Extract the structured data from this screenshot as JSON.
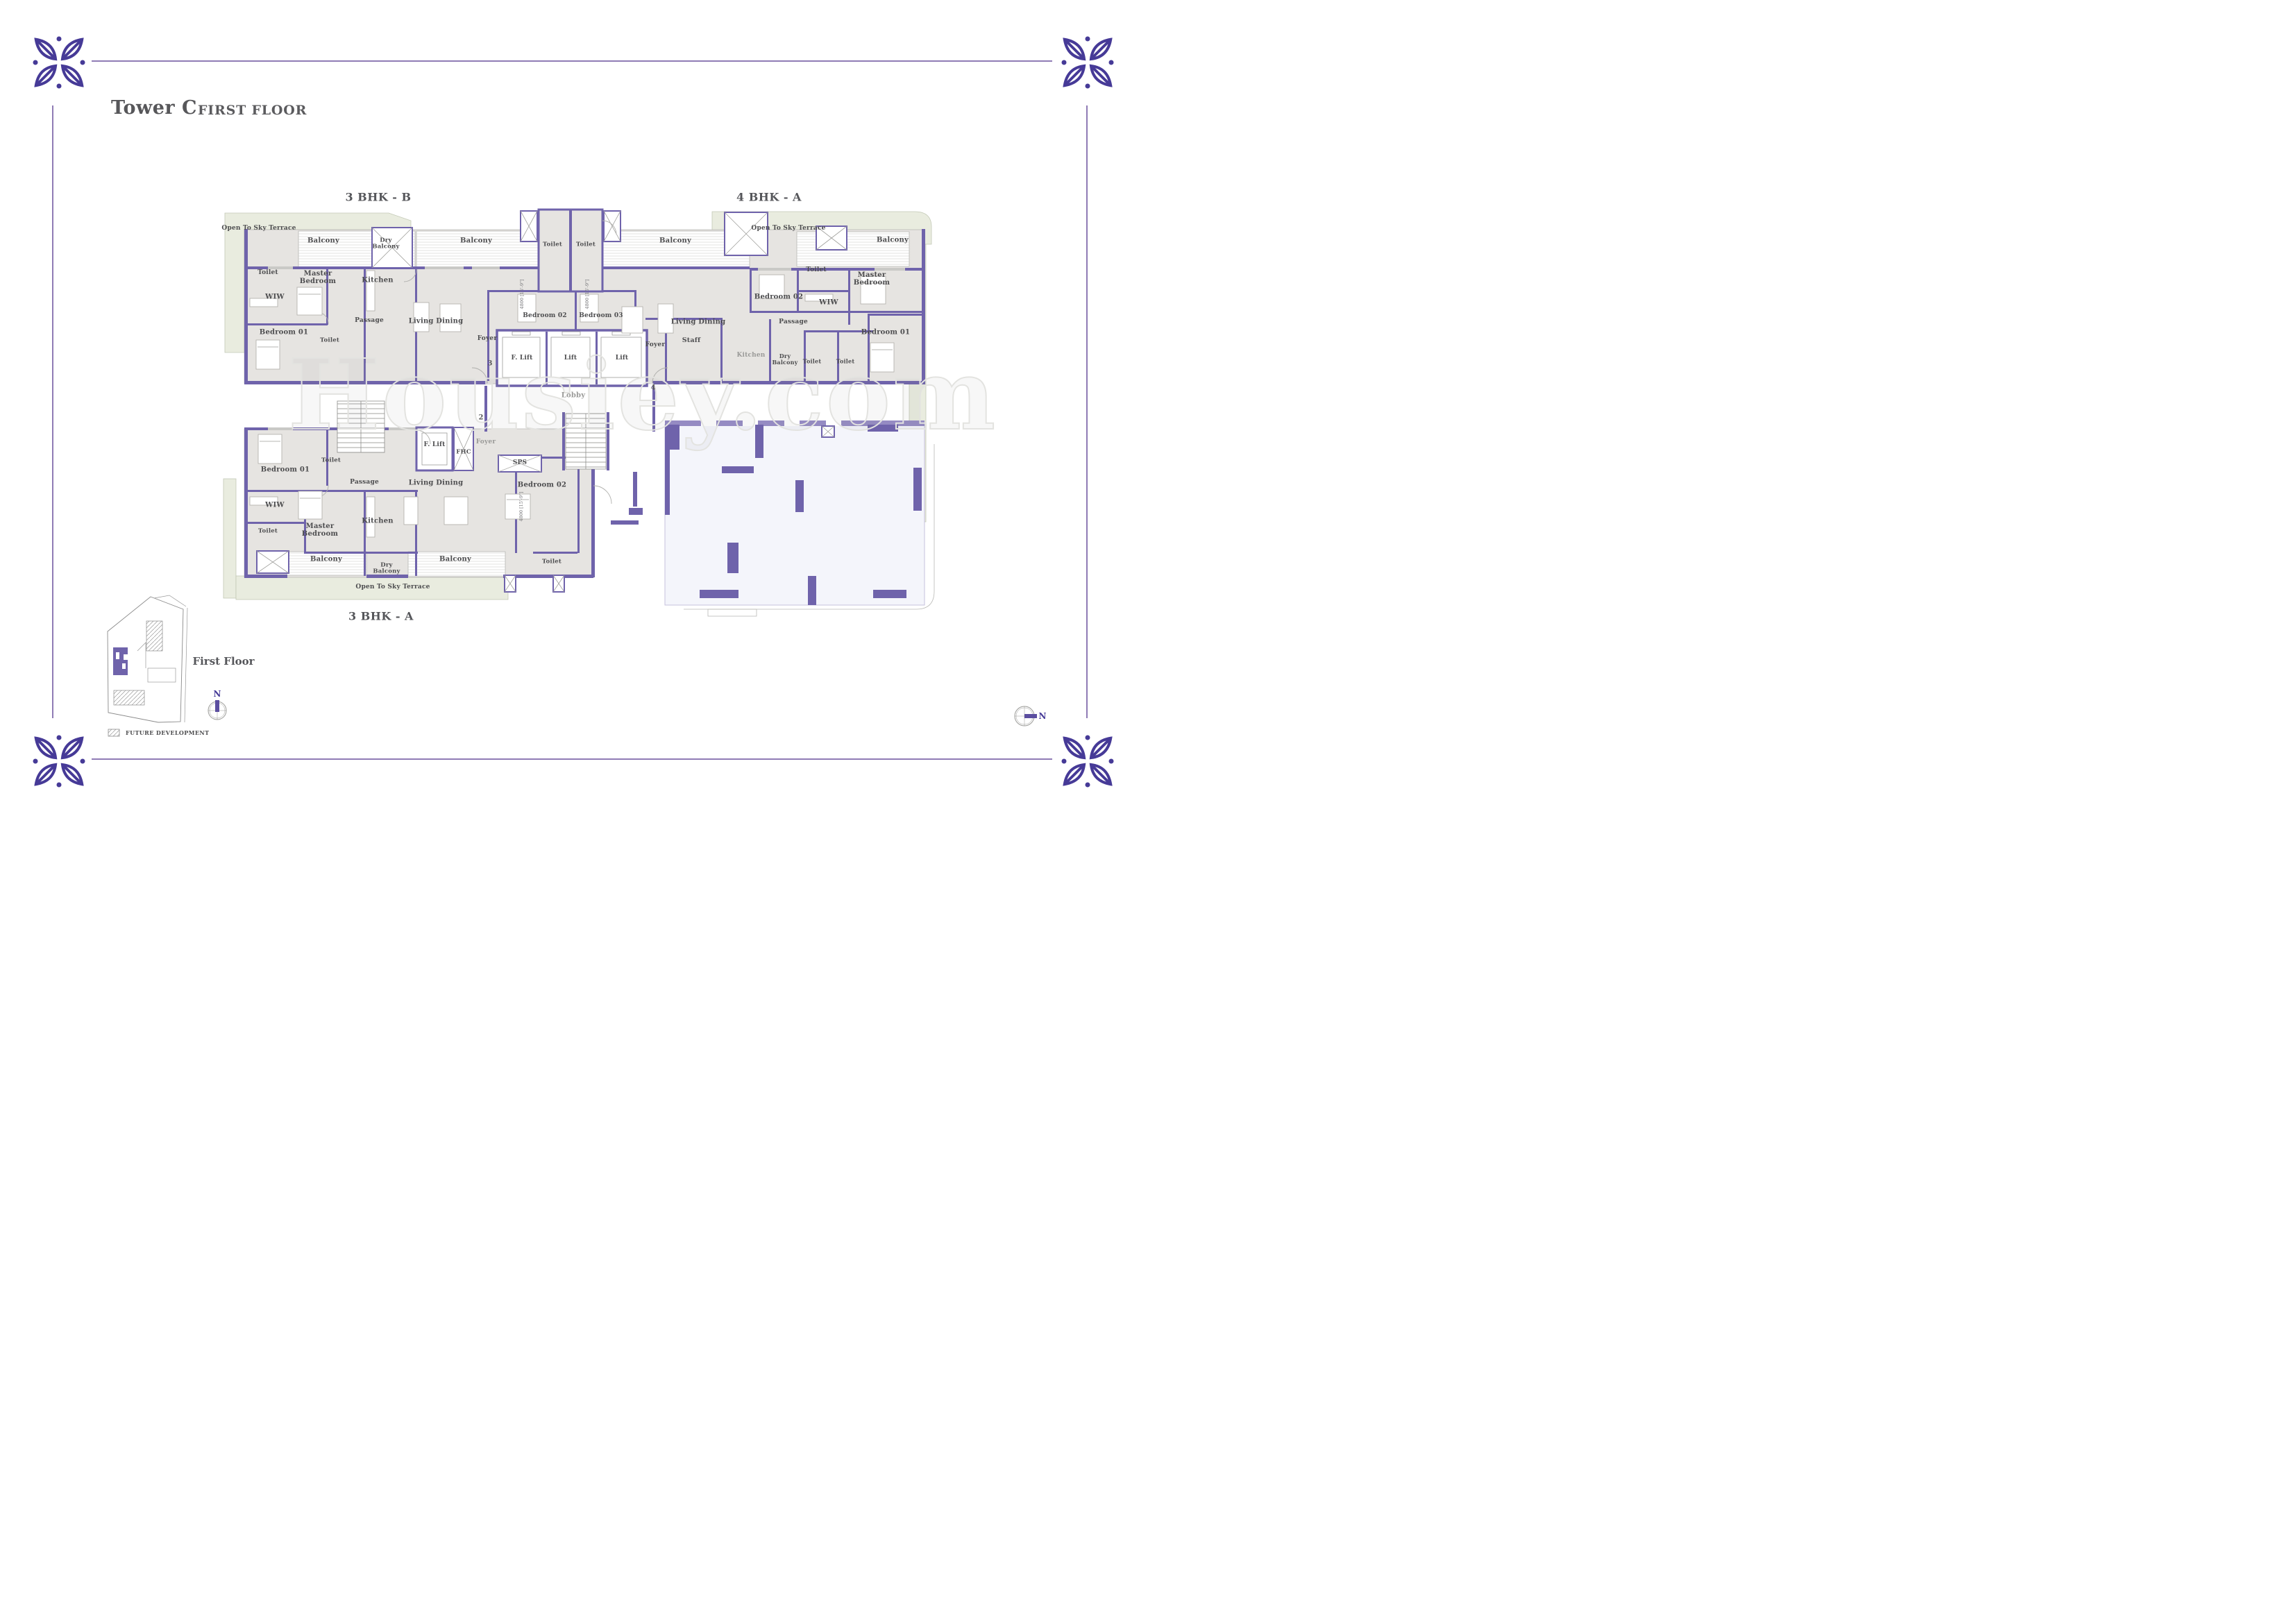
{
  "header": {
    "tower": "Tower C",
    "floor": "FIRST FLOOR"
  },
  "unit_labels": {
    "top_left": "3 BHK - B",
    "top_right": "4 BHK - A",
    "bottom": "3 BHK - A"
  },
  "watermark": "Housiey.com",
  "key_plan": {
    "title": "First Floor",
    "legend": "FUTURE DEVELOPMENT"
  },
  "compass": {
    "north": "N"
  },
  "dimensions": {
    "bedroom_dim": "4800 [15'-9\"]"
  },
  "markers": [
    "3",
    "4",
    "2"
  ],
  "rooms": [
    "Open To Sky Terrace",
    "Balcony",
    "Dry Balcony",
    "Balcony",
    "Toilet",
    "Toilet",
    "Balcony",
    "Open To Sky Terrace",
    "Balcony",
    "Toilet",
    "Master Bedroom",
    "Kitchen",
    "Toilet",
    "Master Bedroom",
    "Bedroom 02",
    "WIW",
    "WIW",
    "Bedroom 02",
    "Bedroom 03",
    "Living Dining",
    "Living Dining",
    "Passage",
    "Passage",
    "Bedroom 01",
    "Bedroom 01",
    "Toilet",
    "Foyer",
    "Staff",
    "Foyer",
    "F. Lift",
    "Lift",
    "Lift",
    "Kitchen",
    "Dry Balcony",
    "Toilet",
    "Toilet",
    "Lobby",
    "Bedroom 01",
    "Toilet",
    "F. Lift",
    "FHC",
    "Foyer",
    "SPS",
    "Passage",
    "Living Dining",
    "Bedroom 02",
    "WIW",
    "Master Bedroom",
    "Kitchen",
    "Toilet",
    "Balcony",
    "Dry Balcony",
    "Balcony",
    "Toilet",
    "Open To Sky Terrace"
  ]
}
